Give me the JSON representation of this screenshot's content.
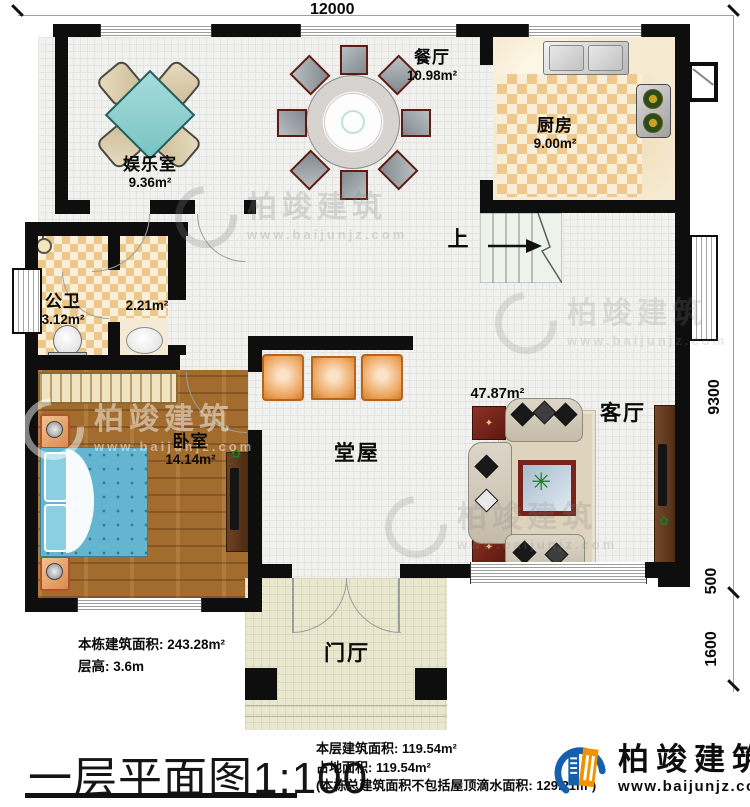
{
  "dimensions": {
    "top": "12000",
    "right_upper": "9300",
    "right_middle": "500",
    "right_lower": "1600"
  },
  "rooms": {
    "entertainment": {
      "name": "娱乐室",
      "area": "9.36m²"
    },
    "dining": {
      "name": "餐厅",
      "area": "10.98m²"
    },
    "kitchen": {
      "name": "厨房",
      "area": "9.00m²"
    },
    "bathroom": {
      "name": "公卫",
      "area": "3.12m²"
    },
    "washroom": {
      "area": "2.21m²"
    },
    "bedroom": {
      "name": "卧室",
      "area": "14.14m²"
    },
    "hall": {
      "name": "堂屋"
    },
    "living": {
      "name": "客厅",
      "area": "47.87m²"
    },
    "foyer": {
      "name": "门厅"
    },
    "stairs": {
      "direction": "上"
    }
  },
  "notes_left": {
    "building_area": "本栋建筑面积: 243.28m²",
    "floor_height": "层高: 3.6m"
  },
  "plan_title": {
    "text": "一层平面图",
    "scale": "1:100"
  },
  "notes_right": {
    "floor_area": "本层建筑面积: 119.54m²",
    "footprint": "占地面积: 119.54m²",
    "note": "(本栋总建筑面积不包括屋顶滴水面积: 129.21m²)"
  },
  "logo": {
    "brand": "柏竣建筑",
    "website": "www.baijunjz.com"
  },
  "watermark": {
    "brand": "柏竣建筑",
    "website": "www.baijunjz.com"
  }
}
